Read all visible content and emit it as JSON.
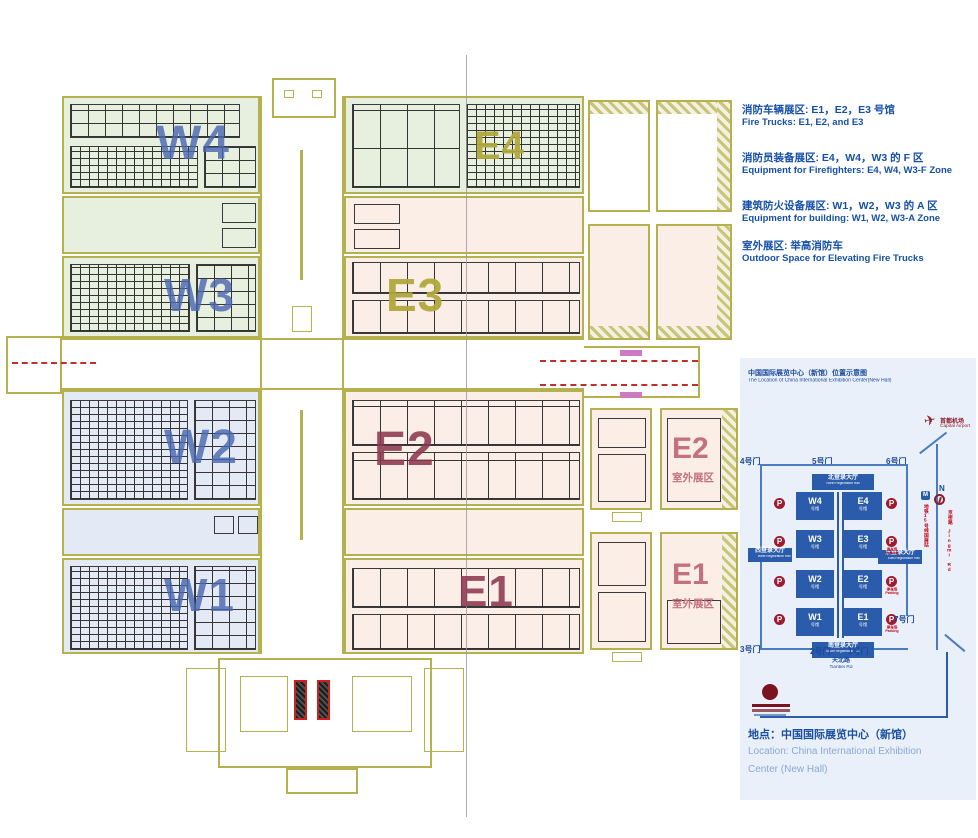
{
  "legend": {
    "items": [
      {
        "zh": "消防车辆展区: E1，E2，E3 号馆",
        "en": "Fire Trucks: E1, E2, and E3"
      },
      {
        "zh": "消防员装备展区: E4，W4，W3 的 F 区",
        "en": "Equipment for Firefighters: E4, W4, W3-F Zone"
      },
      {
        "zh": "建筑防火设备展区: W1，W2，W3 的 A 区",
        "en": "Equipment for building: W1, W2, W3-A Zone"
      },
      {
        "zh": "室外展区: 举高消防车",
        "en": "Outdoor Space for Elevating Fire Trucks"
      }
    ]
  },
  "plan": {
    "halls": {
      "w4": "W4",
      "w3": "W3",
      "w2": "W2",
      "w1": "W1",
      "e4": "E4",
      "e3": "E3",
      "e2": "E2",
      "e1": "E1"
    },
    "outdoor_e2": {
      "code": "E2",
      "label": "室外展区"
    },
    "outdoor_e1": {
      "code": "E1",
      "label": "室外展区"
    }
  },
  "inset": {
    "title_zh": "中国国际展览中心（新馆）位置示意图",
    "title_en": "The Location of China International Exhibition Center(New Hall)",
    "airport": {
      "zh": "首都机场",
      "en": "Capital Airport"
    },
    "gates": {
      "g1": "1号门",
      "g2": "2号门",
      "g3": "3号门",
      "g4": "4号门",
      "g5": "5号门",
      "g6": "6号门",
      "g7": "7号门"
    },
    "hall_sub": "号馆",
    "halls": {
      "w4": "W4",
      "e4": "E4",
      "w3": "W3",
      "e3": "E3",
      "w2": "W2",
      "e2": "E2",
      "w1": "W1",
      "e1": "E1"
    },
    "reg": {
      "north": {
        "zh": "北登录大厅",
        "en": "North Registration Hall"
      },
      "south": {
        "zh": "南登录大厅",
        "en": "South Registration Hall"
      },
      "west": {
        "zh": "西登录大厅",
        "en": "West Registration Hall"
      },
      "east": {
        "zh": "东登录大厅",
        "en": "East Registration Hall"
      }
    },
    "parking_p": "P",
    "parking_caption": {
      "zh": "停车场",
      "en": "Parking"
    },
    "metro_station": "地铁15号线国展站",
    "road_jingmi": {
      "zh": "京密路",
      "en": "Jingmi Rd"
    },
    "road_tianbei": {
      "zh": "天北路",
      "en": "Tianbei Rd"
    },
    "compass": "N"
  },
  "caption": {
    "zh": "地点：中国国际展览中心（新馆）",
    "en1": "Location: China International Exhibition",
    "en2": "Center (New Hall)"
  },
  "colors": {
    "legend_blue": "#1650a8",
    "inset_block_blue": "#2b5cab",
    "parking_red": "#9e1b32",
    "cad_olive": "#b6b14f",
    "hall_green": "#e7efdf",
    "hall_blue": "#e3eaf5",
    "hall_pink": "#faeee6",
    "label_maroon": "#8c3850",
    "dash_red": "#c03028"
  }
}
